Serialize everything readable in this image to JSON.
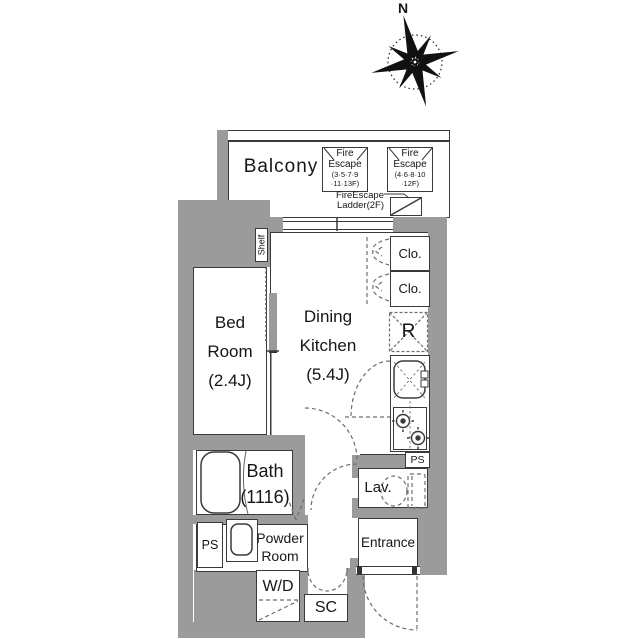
{
  "colors": {
    "wall": "#9b9b9b",
    "line": "#3a3a3a",
    "dash": "#6e6e6e",
    "text": "#161616"
  },
  "compass": {
    "north_label": "N",
    "icon": "compass-rose-icon"
  },
  "balcony": {
    "label": "Balcony"
  },
  "fire_escape_left": {
    "lines": [
      "Fire",
      "Escape",
      "(3·5·7·9",
      "·11·13F)"
    ]
  },
  "fire_escape_right": {
    "lines": [
      "Fire",
      "Escape",
      "(4·6·8·10",
      "·12F)"
    ]
  },
  "fire_escape_ladder": {
    "lines": [
      "FireEscape",
      "Ladder(2F)"
    ]
  },
  "shelf": {
    "label": "Shelf"
  },
  "bedroom": {
    "lines": [
      "Bed",
      "Room",
      "(2.4J)"
    ]
  },
  "dining_kitchen": {
    "lines": [
      "Dining",
      "Kitchen",
      "(5.4J)"
    ]
  },
  "closet_top": {
    "label": "Clo."
  },
  "closet_bottom": {
    "label": "Clo."
  },
  "refrigerator": {
    "label": "R"
  },
  "pipe_space_right": {
    "label": "PS"
  },
  "lavatory": {
    "label": "Lav."
  },
  "entrance": {
    "label": "Entrance"
  },
  "bath": {
    "lines": [
      "Bath",
      "(1116)"
    ]
  },
  "pipe_space_left": {
    "label": "PS"
  },
  "powder_room": {
    "lines": [
      "Powder",
      "Room"
    ]
  },
  "washer_dryer": {
    "label": "W/D"
  },
  "shoe_closet": {
    "label": "SC"
  },
  "fixtures": {
    "bathtub": "bathtub-icon",
    "toilet": "toilet-icon",
    "kitchen_sink": "kitchen-sink-icon",
    "wash_basin": "wash-basin-icon",
    "stove": "stove-burners-icon",
    "ladder": "escape-ladder-icon"
  }
}
